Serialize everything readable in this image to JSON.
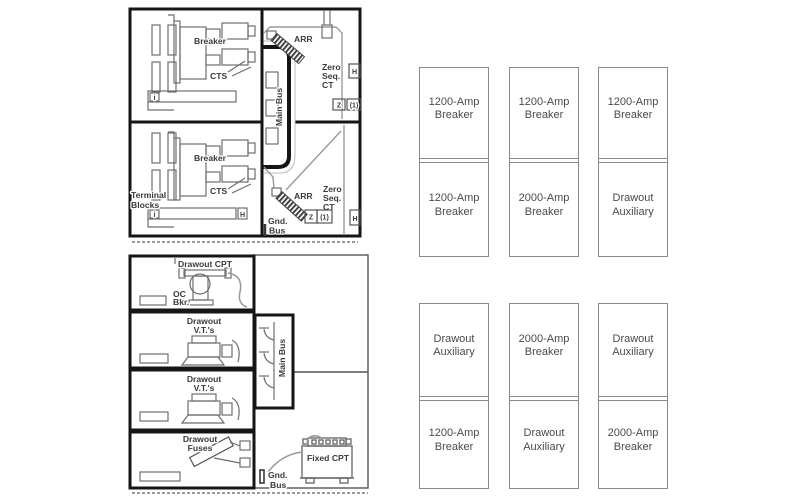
{
  "switchgear": {
    "main_bus": "Main Bus",
    "upper": {
      "breaker": "Breaker",
      "cts": "CTS",
      "arr": "ARR",
      "zero_seq": [
        "Zero",
        "Seq.",
        "CT"
      ],
      "h": "H",
      "z": "Z",
      "z_note": "(1)",
      "i": "i"
    },
    "lower": {
      "terminal_blocks": [
        "Terminal",
        "Blocks"
      ],
      "breaker": "Breaker",
      "cts": "CTS",
      "arr": "ARR",
      "zero_seq": [
        "Zero",
        "Seq.",
        "CT"
      ],
      "h": "H",
      "z": "Z",
      "z_note": "(1)",
      "i": "i",
      "bar_h": "H",
      "gnd_bus": [
        "Gnd.",
        "Bus"
      ]
    }
  },
  "auxiliary": {
    "main_bus": "Main Bus",
    "drawout_cpt": "Drawout CPT",
    "oc_bkr": [
      "OC",
      "Bkr."
    ],
    "drawout_vts_upper": [
      "Drawout",
      "V.T.'s"
    ],
    "drawout_vts_lower": [
      "Drawout",
      "V.T.'s"
    ],
    "drawout_fuses": [
      "Drawout",
      "Fuses"
    ],
    "fixed_cpt": "Fixed CPT",
    "gnd_bus": [
      "Gnd.",
      "Bus"
    ]
  },
  "lineups": [
    {
      "cabinets": [
        {
          "top": "1200-Amp Breaker",
          "bottom": "1200-Amp Breaker"
        },
        {
          "top": "1200-Amp Breaker",
          "bottom": "2000-Amp Breaker"
        },
        {
          "top": "1200-Amp Breaker",
          "bottom": "Drawout Auxiliary"
        }
      ]
    },
    {
      "cabinets": [
        {
          "top": "Drawout Auxiliary",
          "bottom": "1200-Amp Breaker"
        },
        {
          "top": "2000-Amp Breaker",
          "bottom": "Drawout Auxiliary"
        },
        {
          "top": "Drawout Auxiliary",
          "bottom": "2000-Amp Breaker"
        }
      ]
    }
  ],
  "colors": {
    "frame": "#151515",
    "line": "#6e6e6e",
    "cable": "#9a9a9a",
    "label": "#3a3a3a",
    "cell_border": "#8b8b8b",
    "cell_text": "#4a4a4a"
  }
}
